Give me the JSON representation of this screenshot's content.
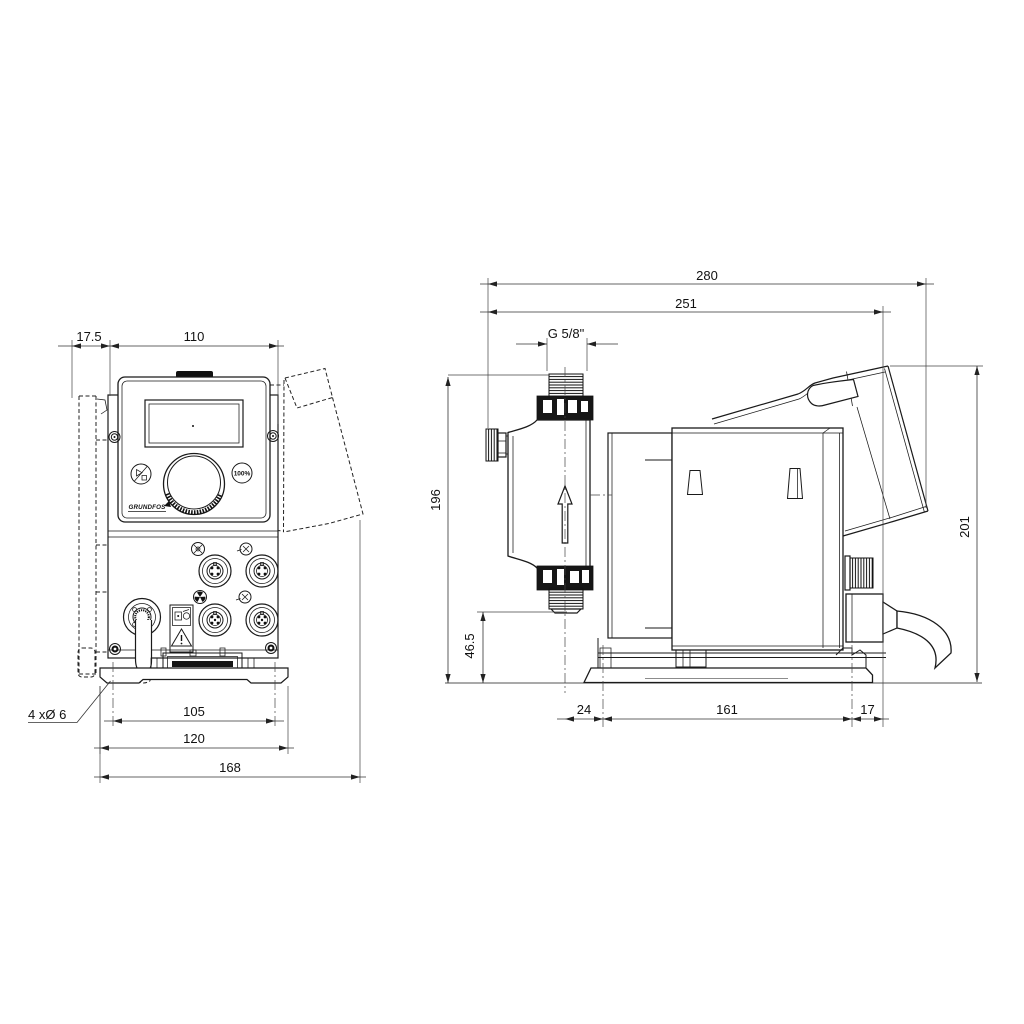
{
  "front_view": {
    "wall_offset": "17.5",
    "housing_width": "110",
    "hole_spacing": "105",
    "plate_width": "120",
    "overall_width": "168",
    "mounting_holes": "4 xØ 6"
  },
  "side_view": {
    "overall_depth": "280",
    "depth_to_control_cube": "251",
    "thread_connection": "G 5/8\"",
    "height_above_base": "196",
    "valve_height": "46.5",
    "base_front_offset": "24",
    "base_hole_spacing": "161",
    "base_rear_offset": "17",
    "overall_height": "201"
  },
  "control_panel": {
    "brand_logo": "GRUNDFOS",
    "max_capacity_button": "100%"
  }
}
